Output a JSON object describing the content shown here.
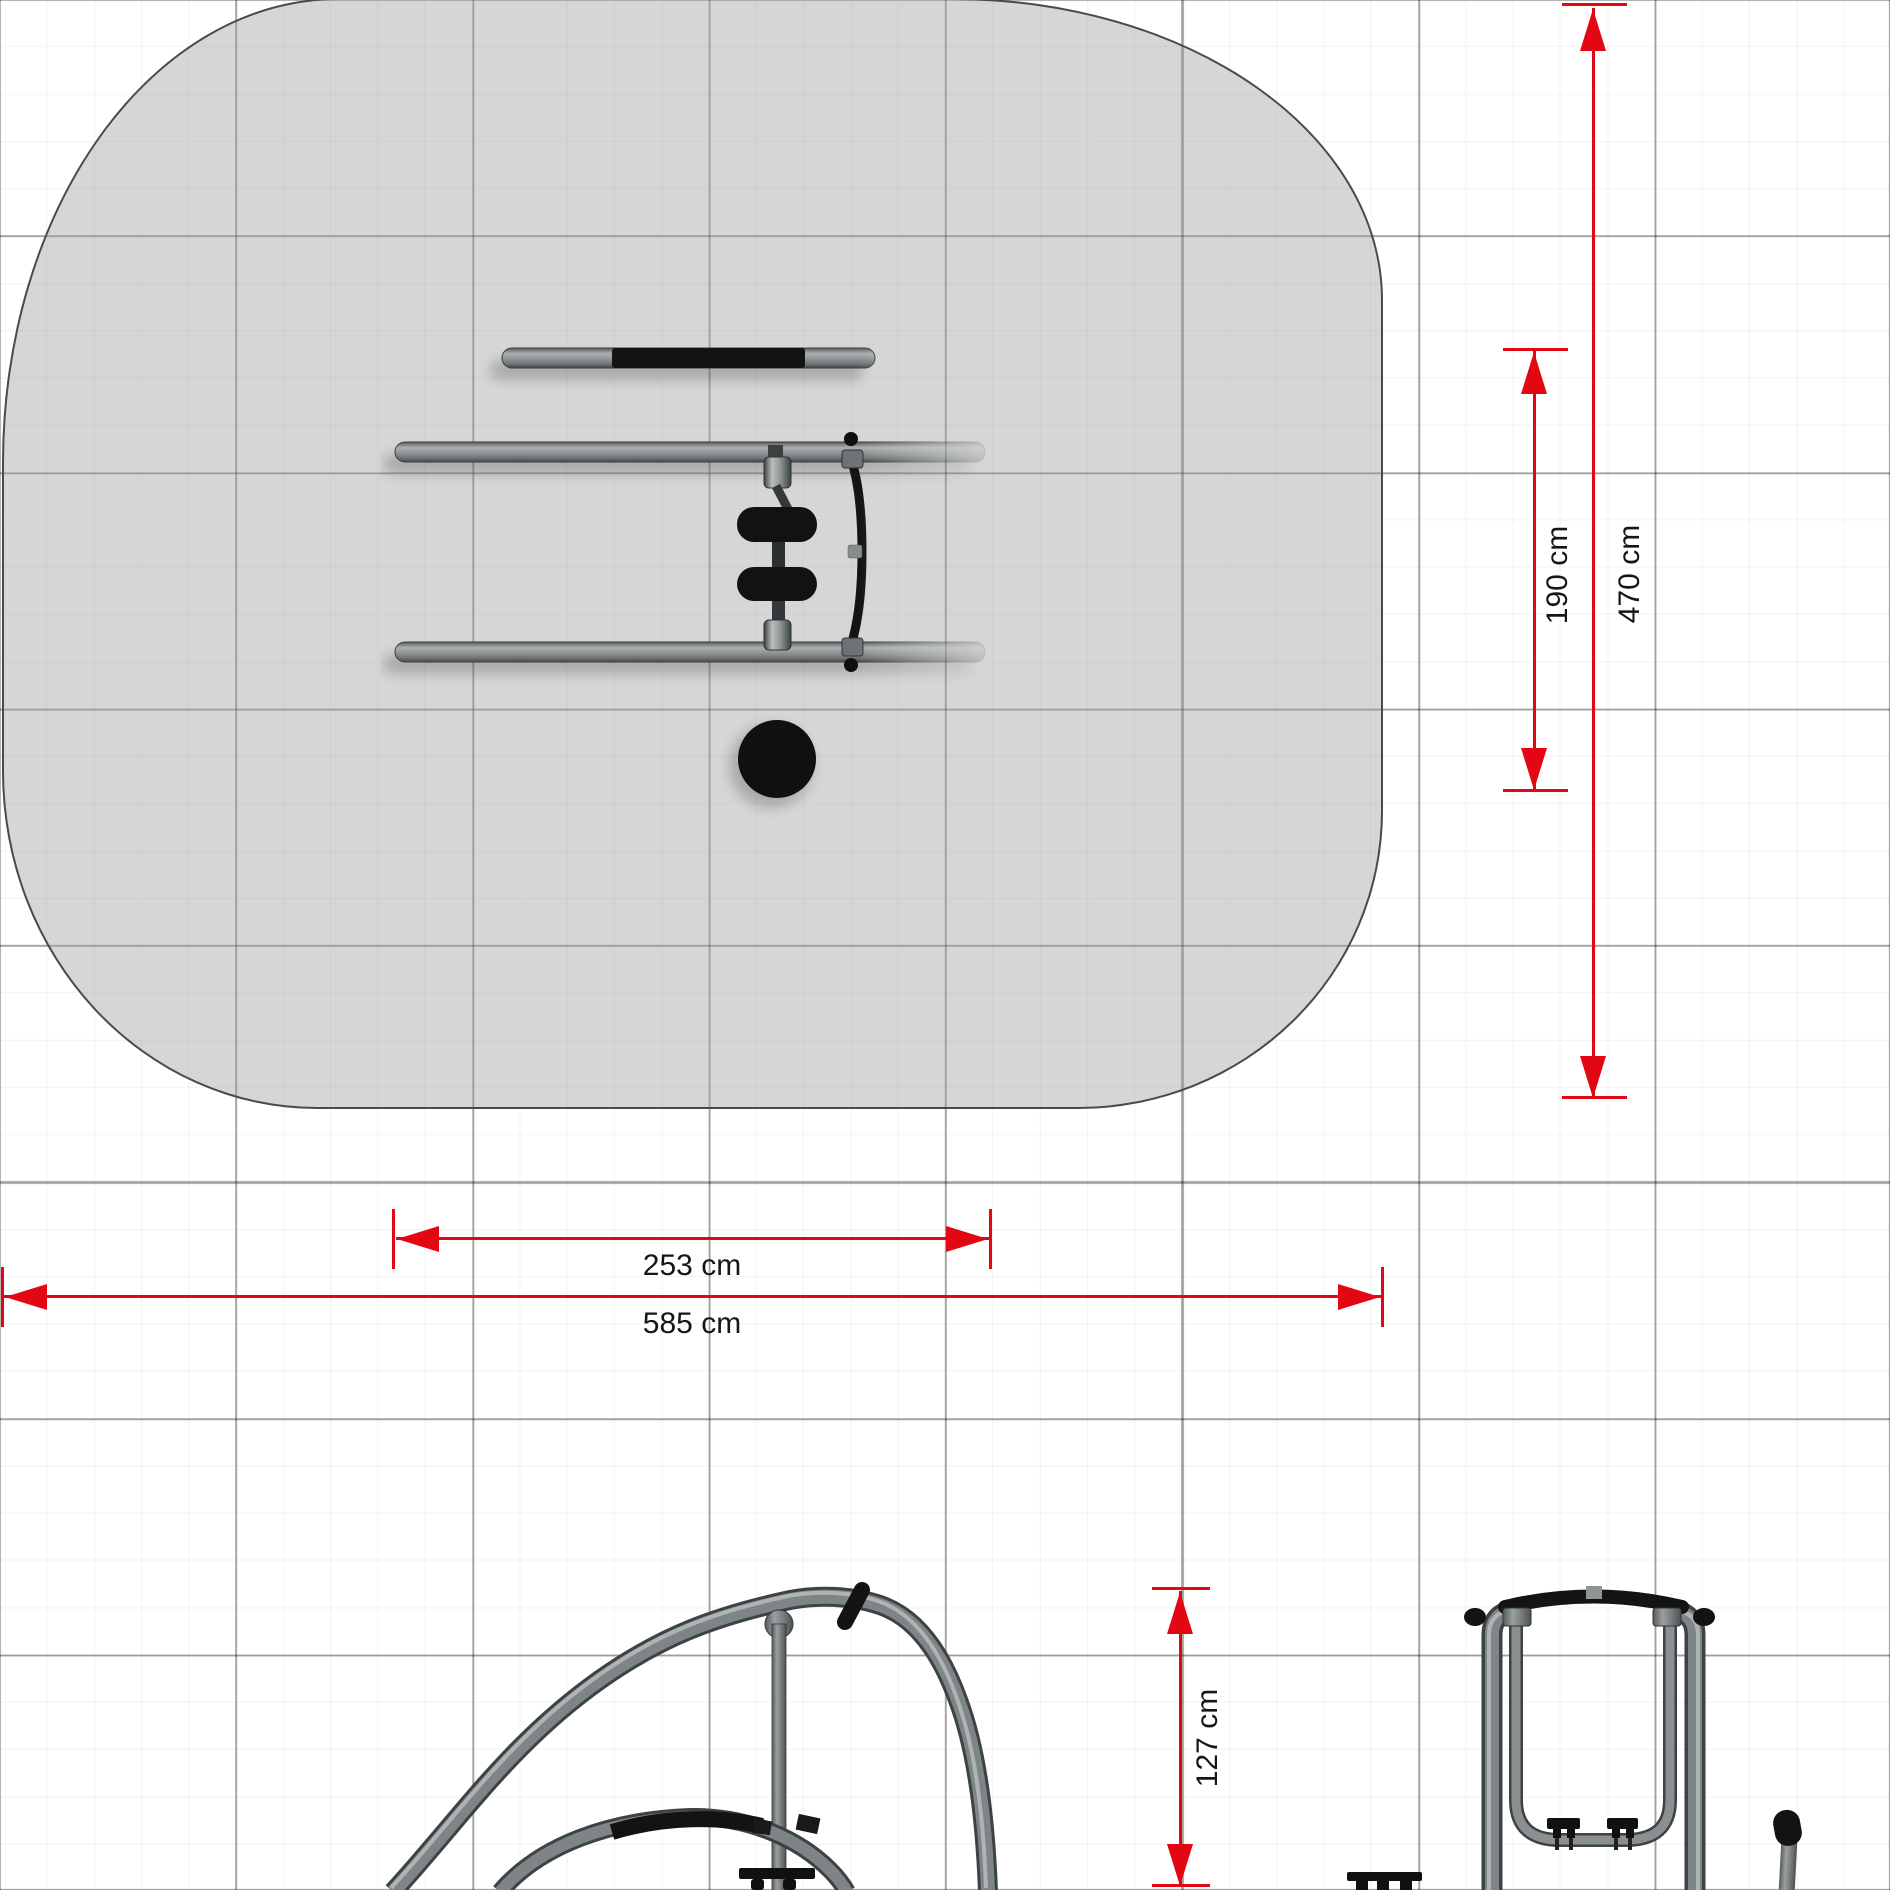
{
  "document": {
    "views": {
      "plan": {
        "labels": {
          "equipment_width": "253 cm",
          "safety_zone_width": "585 cm",
          "equipment_depth": "190 cm",
          "safety_zone_depth": "470 cm"
        }
      },
      "elevation": {
        "labels": {
          "equipment_height": "127 cm"
        }
      }
    },
    "colors": {
      "dimension_red": "#e30613",
      "safety_zone_fill": "#d5d5d5",
      "zone_outline": "#4a4a4a",
      "tube_gray": "#838a8b",
      "grip_black": "#141414",
      "grid_major": "#a0a0a0",
      "grid_minor": "#efefef",
      "label_text": "#161616"
    }
  }
}
